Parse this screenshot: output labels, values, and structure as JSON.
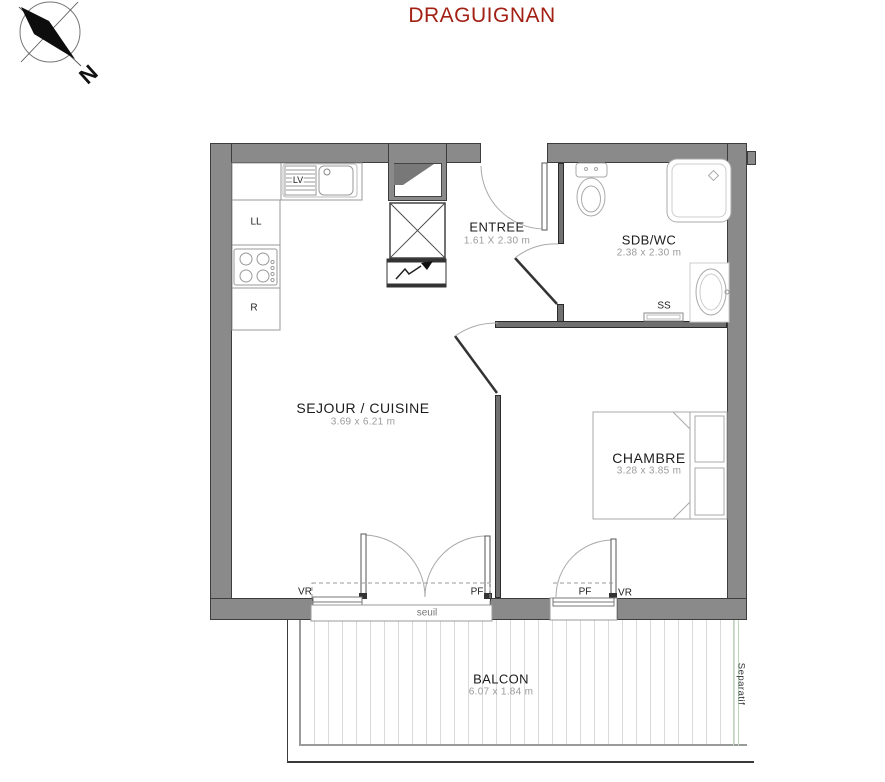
{
  "title": "DRAGUIGNAN",
  "compass": {
    "north": "N"
  },
  "rooms": {
    "entree": {
      "name": "ENTREE",
      "dims": "1.61 X 2.30 m"
    },
    "sdb": {
      "name": "SDB/WC",
      "dims": "2.38 x 2.30 m"
    },
    "sejour": {
      "name": "SEJOUR / CUISINE",
      "dims": "3.69 x 6.21 m"
    },
    "chambre": {
      "name": "CHAMBRE",
      "dims": "3.28 x 3.85 m"
    },
    "balcon": {
      "name": "BALCON",
      "dims": "6.07 x 1.84 m"
    }
  },
  "appliances": {
    "dishwasher": "LV",
    "washing_machine": "LL",
    "fridge": "R",
    "towel_radiator": "SS"
  },
  "openings": {
    "vr_sejour": "VR",
    "pf_sejour": "PF",
    "seuil": "seuil",
    "pf_chambre": "PF",
    "vr_chambre": "VR"
  },
  "balcony": {
    "separator": "Separatif"
  },
  "colors": {
    "title": "#a32014",
    "wall": "#8a8a8a",
    "partition": "#707070",
    "dim_text": "#9b9b9b",
    "separator_line": "#bcd9bc"
  }
}
